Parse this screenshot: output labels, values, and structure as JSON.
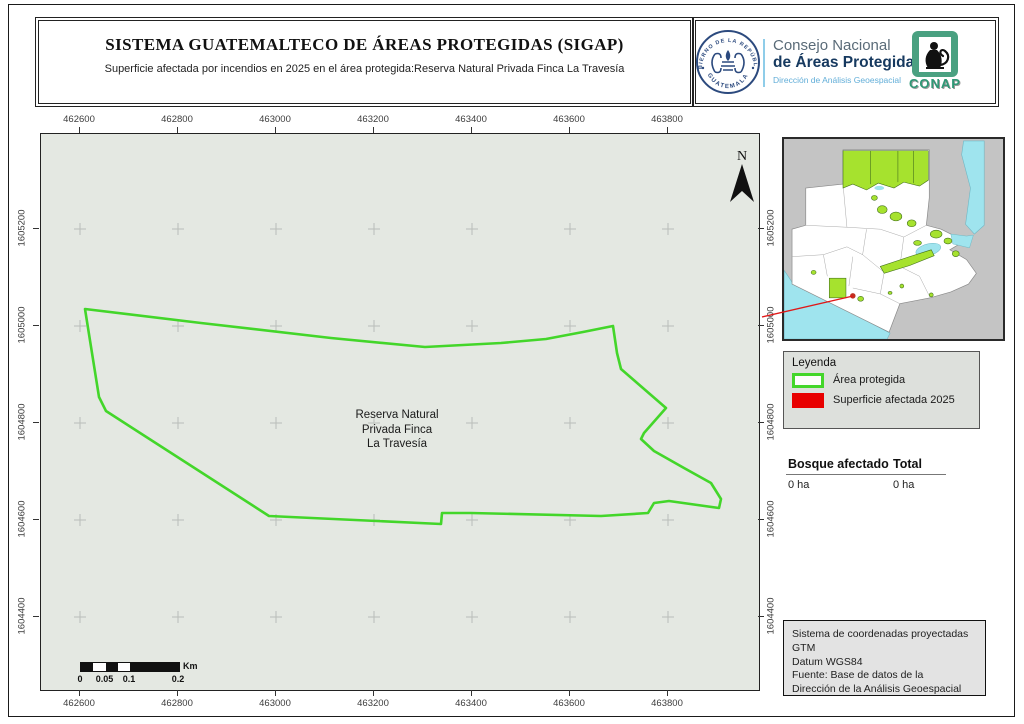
{
  "header": {
    "title": "SISTEMA GUATEMALTECO DE ÁREAS PROTEGIDAS  (SIGAP)",
    "subtitle": "Superficie afectada por incendios en 2025 en el área protegida:Reserva Natural Privada Finca La Travesía",
    "gov_seal": {
      "top_text": "GOBIERNO DE LA REPÚBLICA",
      "bottom_text": "GUATEMALA"
    },
    "org": {
      "line1": "Consejo Nacional",
      "line2": "de Áreas Protegidas",
      "line3": "Dirección de Análisis Geoespacial",
      "logo_text": "CONAP"
    }
  },
  "map": {
    "north_label": "N",
    "area_label_lines": [
      "Reserva Natural",
      "Privada Finca",
      "La Travesía"
    ],
    "x_ticks": [
      "462600",
      "462800",
      "463000",
      "463200",
      "463400",
      "463600",
      "463800"
    ],
    "y_ticks": [
      "1605200",
      "1605000",
      "1604800",
      "1604600",
      "1604400"
    ],
    "background_color": "#e4e8e2",
    "outline_color": "#43d62a",
    "grid_cross_color": "#b9bdb9"
  },
  "scale_bar": {
    "labels": [
      "0",
      "0.05",
      "0.1",
      "0.2"
    ],
    "unit": "Km"
  },
  "legend": {
    "title": "Leyenda",
    "items": [
      {
        "label": "Área protegida",
        "swatch": "outline",
        "color": "#43d62a"
      },
      {
        "label": "Superficie afectada 2025",
        "swatch": "fill",
        "color": "#e80000"
      }
    ]
  },
  "stats": {
    "col1": "Bosque afectado",
    "col2": "Total",
    "val1": "0 ha",
    "val2": "0 ha"
  },
  "credits": {
    "lines": [
      "Sistema de coordenadas proyectadas",
      "GTM",
      "Datum WGS84",
      "Fuente: Base de datos de la",
      "Dirección de la Análisis Geoespacial"
    ]
  },
  "inset": {
    "accent_line_color": "#e01818",
    "protected_color": "#a6e22e",
    "water_color": "#9fe4ee"
  }
}
